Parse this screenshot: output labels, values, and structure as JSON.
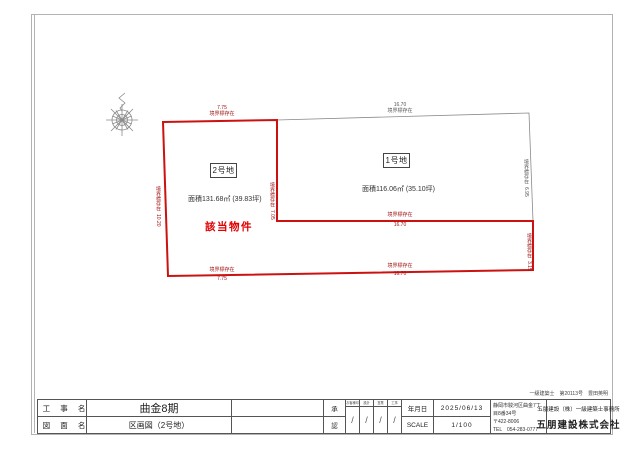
{
  "plan": {
    "lot2": {
      "name": "2号地",
      "area": "面積131.68㎡ (39.83坪)",
      "tag": "該当物件"
    },
    "lot1": {
      "name": "1号地",
      "area": "面積116.06㎡ (35.10坪)"
    },
    "dims": {
      "top_lot2": {
        "value": "7.75",
        "note": "境界標存在"
      },
      "top_lot1": {
        "value": "16.70",
        "note": "境界標存在"
      },
      "left": {
        "value": "10.20",
        "note": "境界標存在"
      },
      "divider": {
        "value": "7.05",
        "note": "境界標存在"
      },
      "right_lot1": {
        "value": "6.95",
        "note": "境界標存在"
      },
      "right_strip": {
        "value": "3.15",
        "note": "境界標存在"
      },
      "strip_top": {
        "value": "16.70",
        "note": "境界標存在"
      },
      "bottom_left": {
        "value": "7.75",
        "note": "境界標存在"
      },
      "bottom_right": {
        "value": "16.70",
        "note": "境界標存在"
      }
    },
    "colors": {
      "boundary_red": "#cc1111",
      "line_gray": "#8a8a8a"
    }
  },
  "titleblock": {
    "project_label": "工 事 名",
    "project_value": "曲金8期",
    "drawing_label": "図 面 名",
    "drawing_value": "区画図（2号地）",
    "approval_top": "承",
    "approval_bottom": "認",
    "sign_columns": [
      {
        "header": "お客様印",
        "mark": "/"
      },
      {
        "header": "設計",
        "mark": "/"
      },
      {
        "header": "営業",
        "mark": "/"
      },
      {
        "header": "工事",
        "mark": "/"
      }
    ],
    "date_label": "年月日",
    "date_value": "2025/06/13",
    "scale_label": "SCALE",
    "scale_value": "1/100",
    "address": {
      "line1": "静岡市駿河区曲金7丁目8番34号",
      "line2": "〒422-8006",
      "line3": "TEL　054-283-0777"
    },
    "license_line": "一級建築士　第20113号　豊田英明",
    "office_line": "五朋建設（株）一級建築士事務所",
    "company_name": "五朋建設株式会社"
  }
}
